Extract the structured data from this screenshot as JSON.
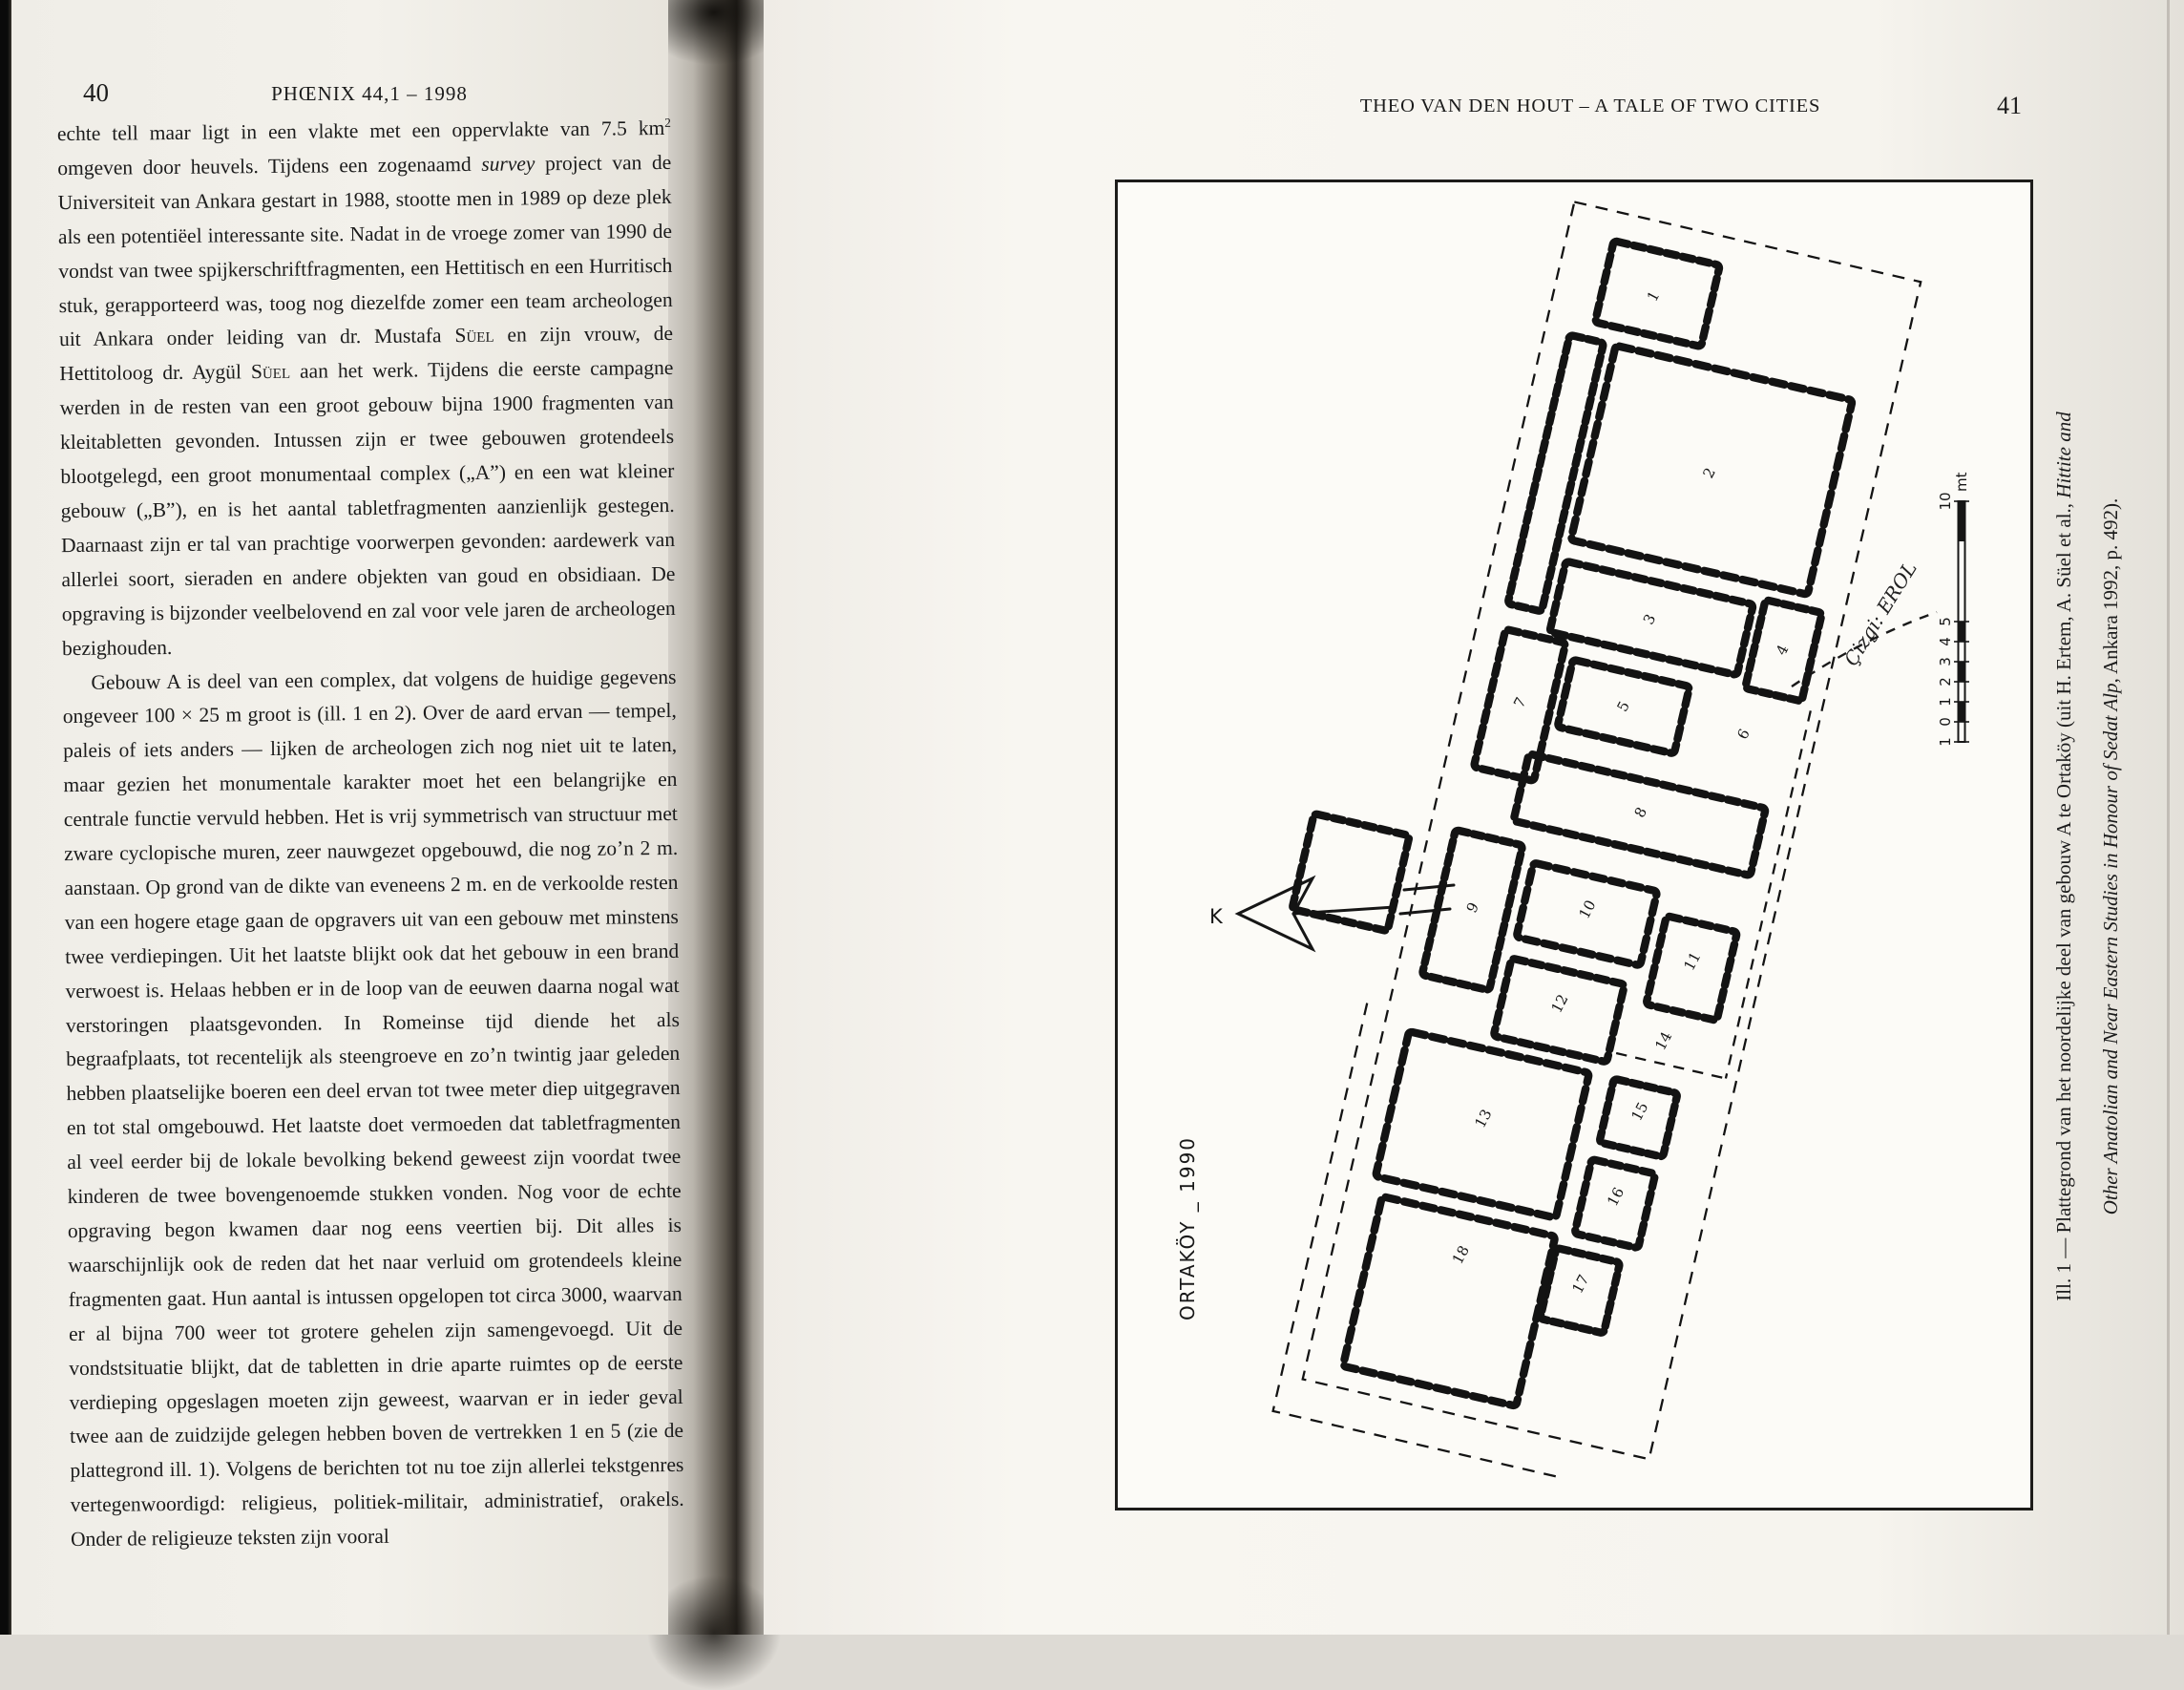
{
  "left_page": {
    "page_number": "40",
    "running_head": "PHŒNIX 44,1 – 1998",
    "paragraphs": [
      {
        "segments": [
          {
            "t": "echte tell maar ligt in een vlakte met een oppervlakte van 7.5 km"
          },
          {
            "t": "2",
            "s": "sup"
          },
          {
            "t": " omgeven door heuvels. Tijdens een zogenaamd "
          },
          {
            "t": "survey",
            "s": "i"
          },
          {
            "t": " project van de Universiteit van Ankara gestart in 1988, stootte men in 1989 op deze plek als een potentiëel interessante site. Nadat in de vroege zomer van 1990 de vondst van twee spijkerschriftfragmenten, een Hettitisch en een Hurritisch stuk, gerapporteerd was, toog nog diezelfde zomer een team archeologen uit Ankara onder leiding van dr. Mustafa "
          },
          {
            "t": "Süel",
            "s": "sc"
          },
          {
            "t": " en zijn vrouw, de Hettitoloog dr. Aygül "
          },
          {
            "t": "Süel",
            "s": "sc"
          },
          {
            "t": " aan het werk. Tijdens die eerste campagne werden in de resten van een groot gebouw bijna 1900 fragmenten van kleitabletten gevonden. Intussen zijn er twee gebouwen grotendeels blootgelegd, een groot monumentaal complex („A”) en een wat kleiner gebouw („B”), en is het aantal tabletfragmenten aanzienlijk gestegen. Daarnaast zijn er tal van prachtige voorwerpen gevonden: aardewerk van allerlei soort, sieraden en andere objekten van goud en obsidiaan. De opgraving is bijzonder veelbelovend en zal voor vele jaren de archeologen bezighouden."
          }
        ]
      },
      {
        "indent": true,
        "segments": [
          {
            "t": "Gebouw A is deel van een complex, dat volgens de huidige gegevens ongeveer 100 × 25 m groot is (ill. 1 en 2). Over de aard ervan — tempel, paleis of iets anders — lijken de archeologen zich nog niet uit te laten, maar gezien het monumentale karakter moet het een belangrijke en centrale functie vervuld hebben. Het is vrij symmetrisch van structuur met zware cyclopische muren, zeer nauwgezet opgebouwd, die nog zo’n 2 m. aanstaan. Op grond van de dikte van eveneens 2 m. en de verkoolde resten van een hogere etage gaan de opgravers uit van een gebouw met minstens twee verdiepingen. Uit het laatste blijkt ook dat het gebouw in een brand verwoest is. Helaas hebben er in de loop van de eeuwen daarna nogal wat verstoringen plaatsgevonden. In Romeinse tijd diende het als begraafplaats, tot recentelijk als steengroeve en zo’n twintig jaar geleden hebben plaatselijke boeren een deel ervan tot twee meter diep uitgegraven en tot stal omgebouwd. Het laatste doet vermoeden dat tabletfragmenten al veel eerder bij de lokale bevolking bekend geweest zijn voordat twee kinderen de twee bovengenoemde stukken vonden. Nog voor de echte opgraving begon kwamen daar nog eens veertien bij. Dit alles is waarschijnlijk ook de reden dat het naar verluid om grotendeels kleine fragmenten gaat. Hun aantal is intussen opgelopen tot circa 3000, waarvan er al bijna 700 weer tot grotere gehelen zijn samengevoegd. Uit de vondstsituatie blijkt, dat de tabletten in drie aparte ruimtes op de eerste verdieping opgeslagen moeten zijn geweest, waarvan er in ieder geval twee aan de zuidzijde gelegen hebben boven de vertrekken 1 en 5 (zie de plattegrond ill. 1). Volgens de berichten tot nu toe zijn allerlei tekstgenres vertegenwoordigd: religieus, politiek-militair, administratief, orakels. Onder de religieuze teksten zijn vooral"
          }
        ]
      }
    ]
  },
  "right_page": {
    "page_number": "41",
    "running_head": "THEO VAN DEN HOUT – A TALE OF TWO CITIES",
    "figure": {
      "plan_title": "ORTAKÖY _ 1990",
      "drawing_credit": "Çizgi: EROL",
      "north_label": "K",
      "scale_numbers": [
        "1",
        "0",
        "1",
        "2",
        "3",
        "4",
        "5",
        "10"
      ],
      "scale_unit": "mt",
      "room_numbers": [
        "1",
        "2",
        "3",
        "4",
        "5",
        "6",
        "7",
        "8",
        "9",
        "10",
        "11",
        "12",
        "13",
        "14",
        "15",
        "16",
        "17",
        "18"
      ],
      "caption": {
        "line1_roman": "Ill. 1 — Plattegrond van het noordelijke deel van gebouw A te Ortaköy (uit H. Ertem, A. Süel et al., ",
        "line1_italic": "Hittite and",
        "line2_italic": "Other Anatolian and Near Eastern Studies in Honour of Sedat Alp",
        "line2_roman": ", Ankara 1992, p. 492)."
      }
    }
  }
}
